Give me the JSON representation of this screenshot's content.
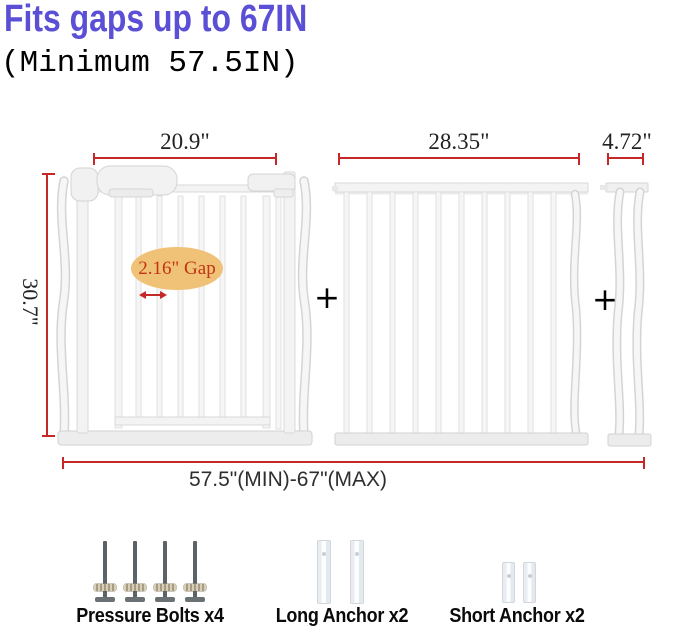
{
  "title": "Fits gaps up to 67IN",
  "subtitle": "(Minimum 57.5IN)",
  "plus": "+",
  "colors": {
    "title_blue": "#5b4fd5",
    "dimension_red": "#c62828",
    "gap_ellipse_fill": "#f0c278",
    "gap_text_red": "#c23412",
    "gate_white": "#f5f5f5"
  },
  "dimensions": {
    "gate_width": "20.9\"",
    "extension_width": "28.35\"",
    "small_extension_width": "4.72\"",
    "height": "30.7\"",
    "gap": "2.16\" Gap",
    "total_range": "57.5\"(MIN)-67\"(MAX)"
  },
  "accessories": [
    {
      "label": "Pressure Bolts x4",
      "count": 4
    },
    {
      "label": "Long Anchor x2",
      "count": 2
    },
    {
      "label": "Short Anchor x2",
      "count": 2
    }
  ]
}
